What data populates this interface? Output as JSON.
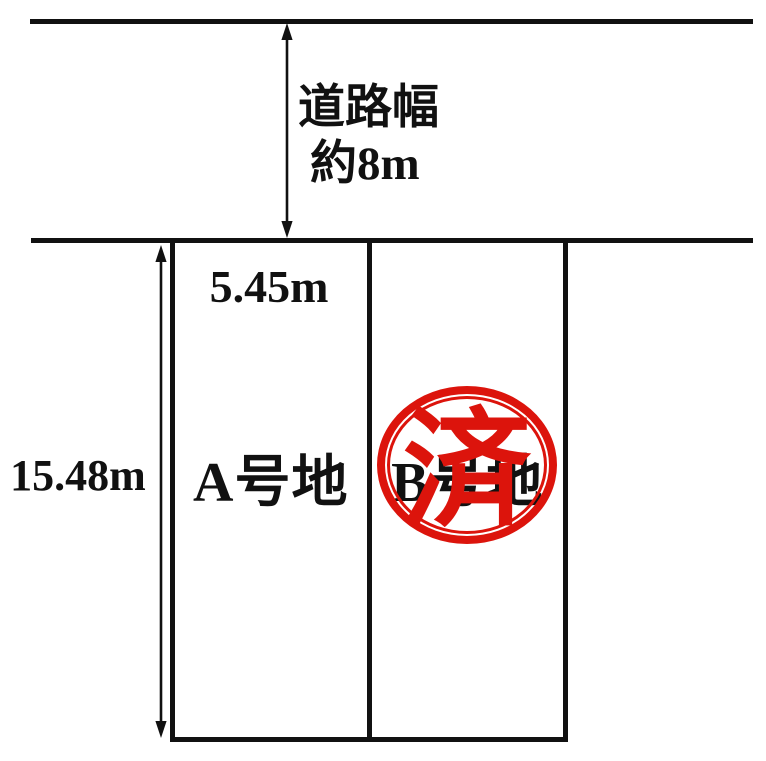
{
  "road": {
    "width_label_line1": "道路幅",
    "width_label_line2": "約8m"
  },
  "plots": [
    {
      "id": "A",
      "label": "A号地",
      "frontage": "5.45m"
    },
    {
      "id": "B",
      "label": "B号地",
      "stamp": "済"
    }
  ],
  "depth_label": "15.48m",
  "colors": {
    "line_black": "#111111",
    "stamp_red": "#dc140c",
    "background": "#ffffff"
  }
}
